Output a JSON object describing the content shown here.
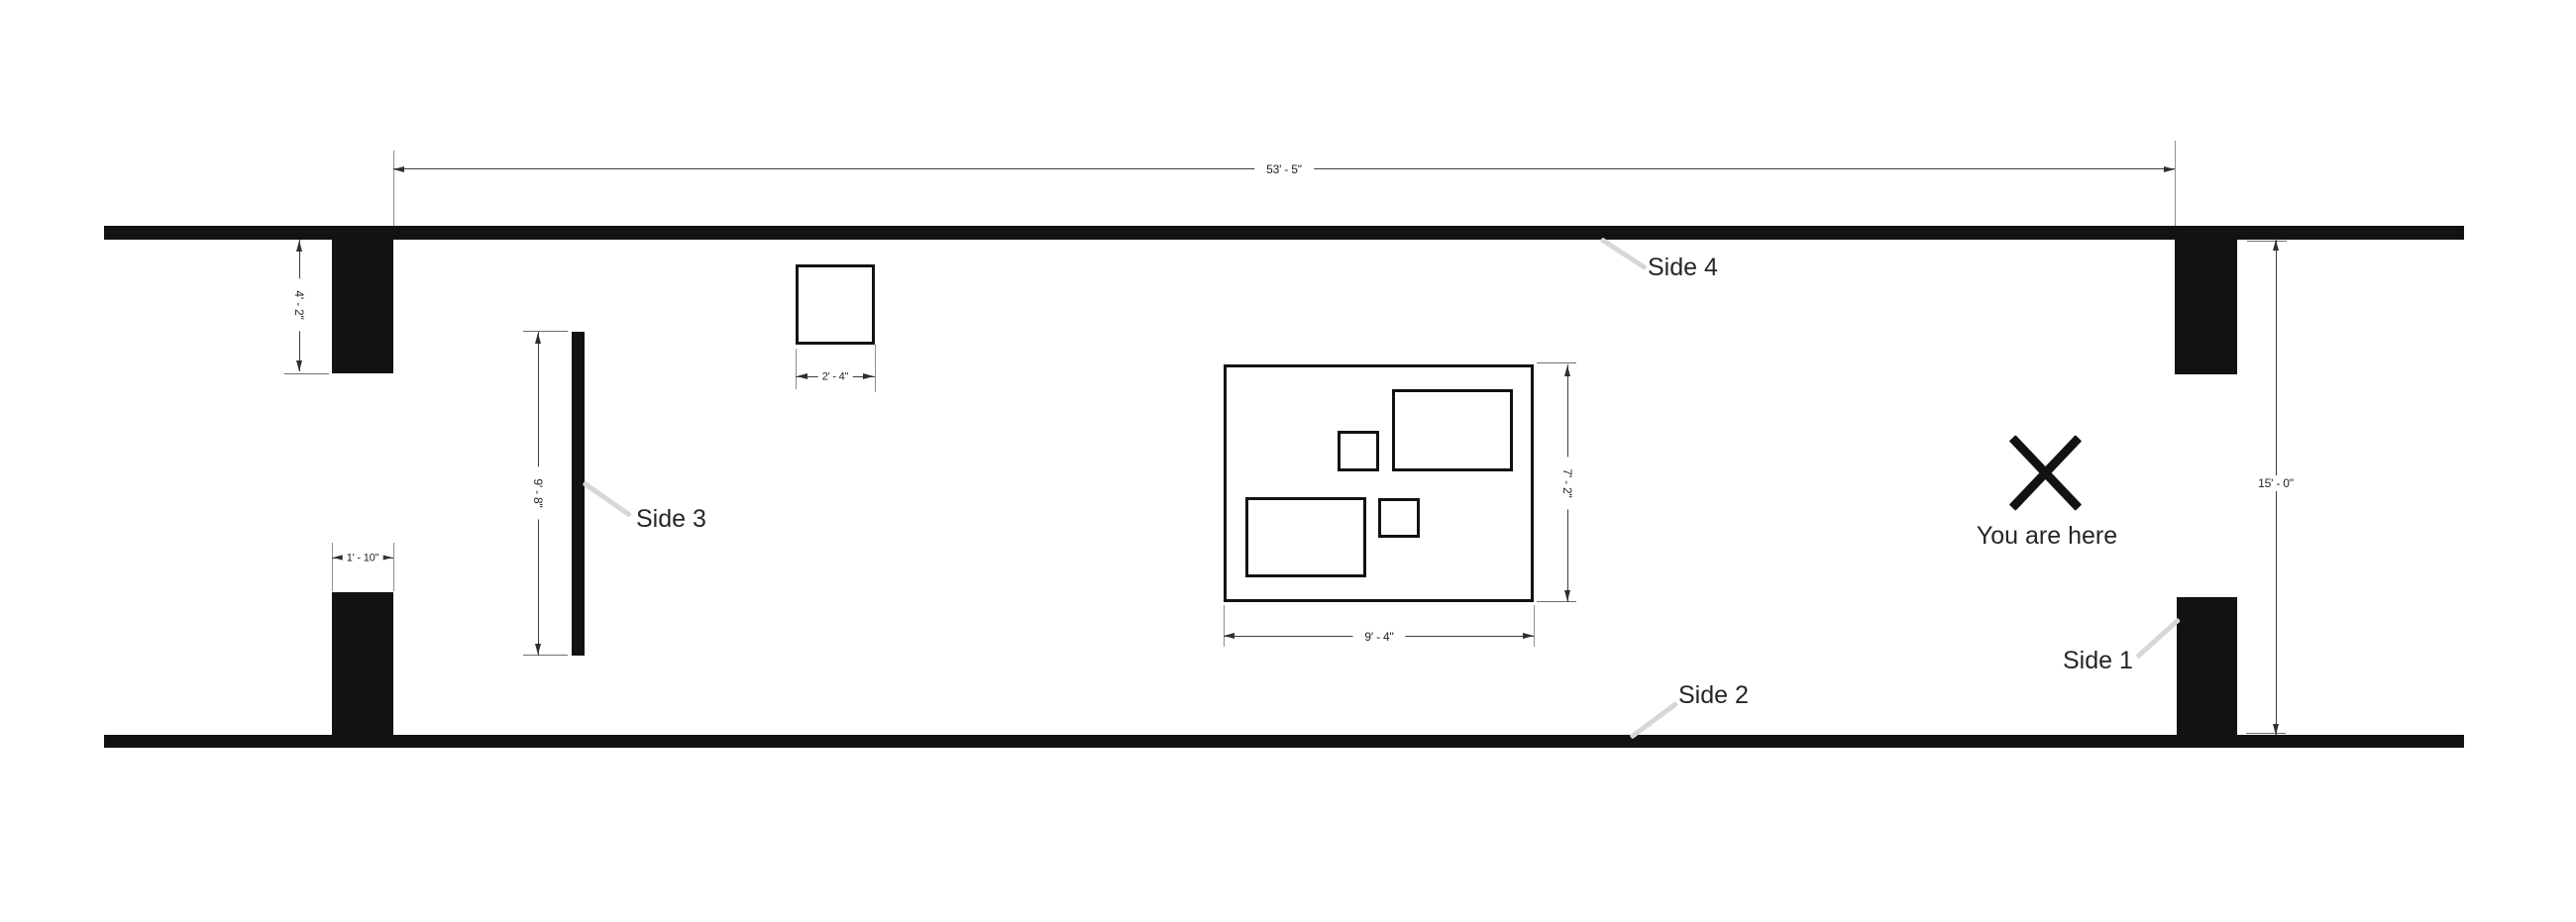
{
  "plan": {
    "title": "booth-floor-plan",
    "labels": {
      "side1": "Side 1",
      "side2": "Side 2",
      "side3": "Side 3",
      "side4": "Side 4",
      "you_are_here": "You are here"
    },
    "dims": {
      "room_width": "53' - 5\"",
      "room_height": "15' - 0\"",
      "pillar_height": "4' - 2\"",
      "pillar_width": "1' - 10\"",
      "square_width": "2' - 4\"",
      "side3_length": "9' - 8\"",
      "display_width": "9' - 4\"",
      "display_height": "7' - 2\""
    },
    "icons": {
      "you_are_here_marker": "x-cross"
    },
    "colors": {
      "wall": "#121212",
      "dim_line": "#3d3d3d",
      "extension_line": "#8f8f8f",
      "leader_line": "#d7d7d7",
      "text": "#231f20",
      "background": "#ffffff"
    }
  }
}
